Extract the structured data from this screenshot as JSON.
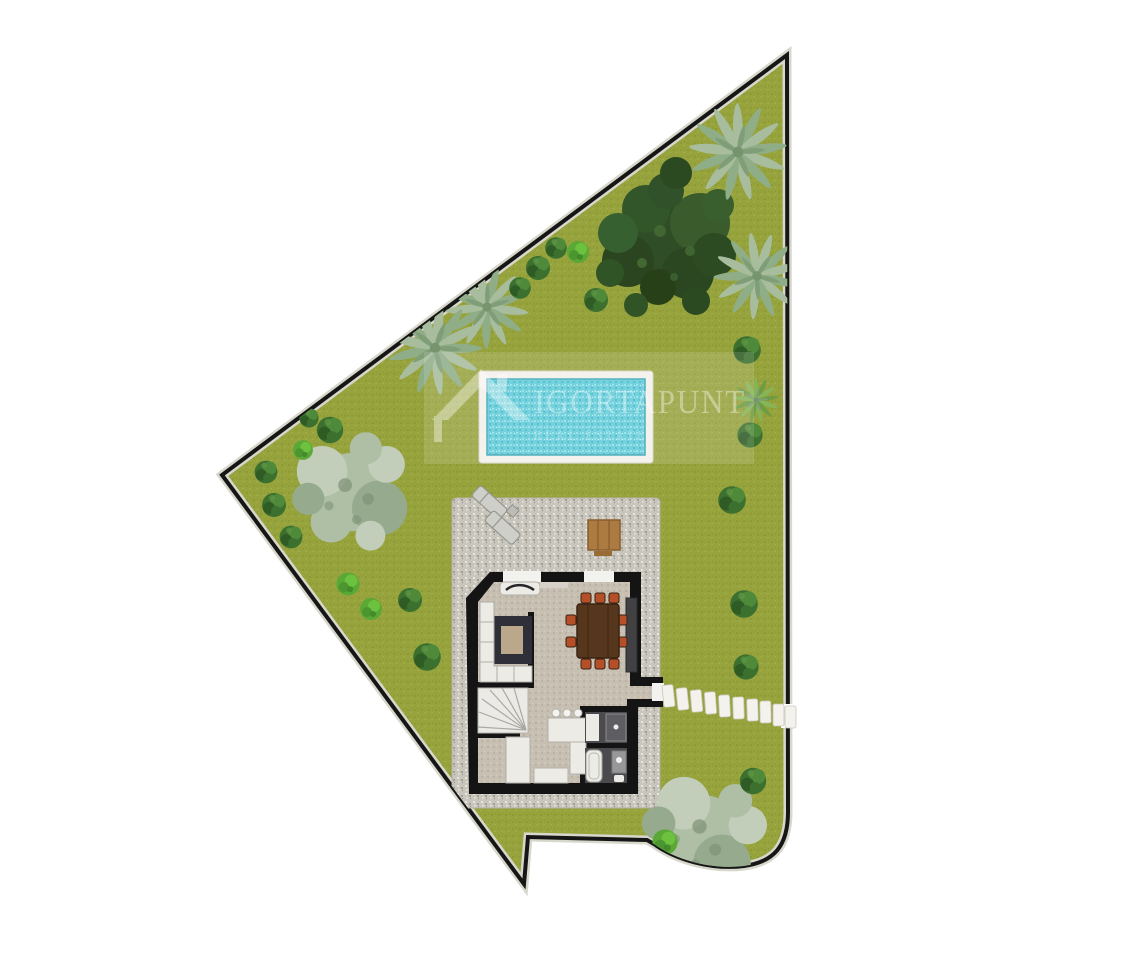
{
  "watermark": {
    "brand": "IGORTAPUNT",
    "tagline": "REAL ESTATE"
  },
  "palette": {
    "page_bg": "#ffffff",
    "grass": "#97a33d",
    "grass_dark": "#8d9a35",
    "grass_light": "#a2ae46",
    "boundary_wall": "#161616",
    "boundary_trim": "#d8d7cc",
    "pool_water": "#5fccd8",
    "pool_water_light": "#8fdde6",
    "pool_water_dark": "#49b5c4",
    "pool_deck": "#f3f1ea",
    "gravel": "#c8c5bc",
    "gravel_light": "#e9e7df",
    "gravel_dark": "#a39f96",
    "house_wall": "#141414",
    "floor": "#c6bfb2",
    "floor_dark": "#b9b1a2",
    "bath_floor": "#4b4b4d",
    "fixture_white": "#ecebe6",
    "dining_table": "#56361c",
    "chair_accent": "#b44f28",
    "sideboard": "#414144",
    "rug": "#2e2f38",
    "rug_throw": "#c8b291",
    "wood_table": "#ab7b41",
    "wood_dark": "#8a5c2c",
    "stone_path": "#f4f2ec",
    "tree_dark": "#2f4d26",
    "tree_dark2": "#3a5c2d",
    "palm": "#a7bd9e",
    "palm_dark": "#8fae88",
    "olive": "#aebfa6",
    "olive_light": "#c2cdba",
    "olive_dark": "#96ab8e",
    "bush": "#3c702f",
    "bush_light": "#4f8a3a",
    "bush_bright": "#5aa835",
    "bush_bright2": "#6cc13f",
    "lounger": "#cfcfca"
  }
}
